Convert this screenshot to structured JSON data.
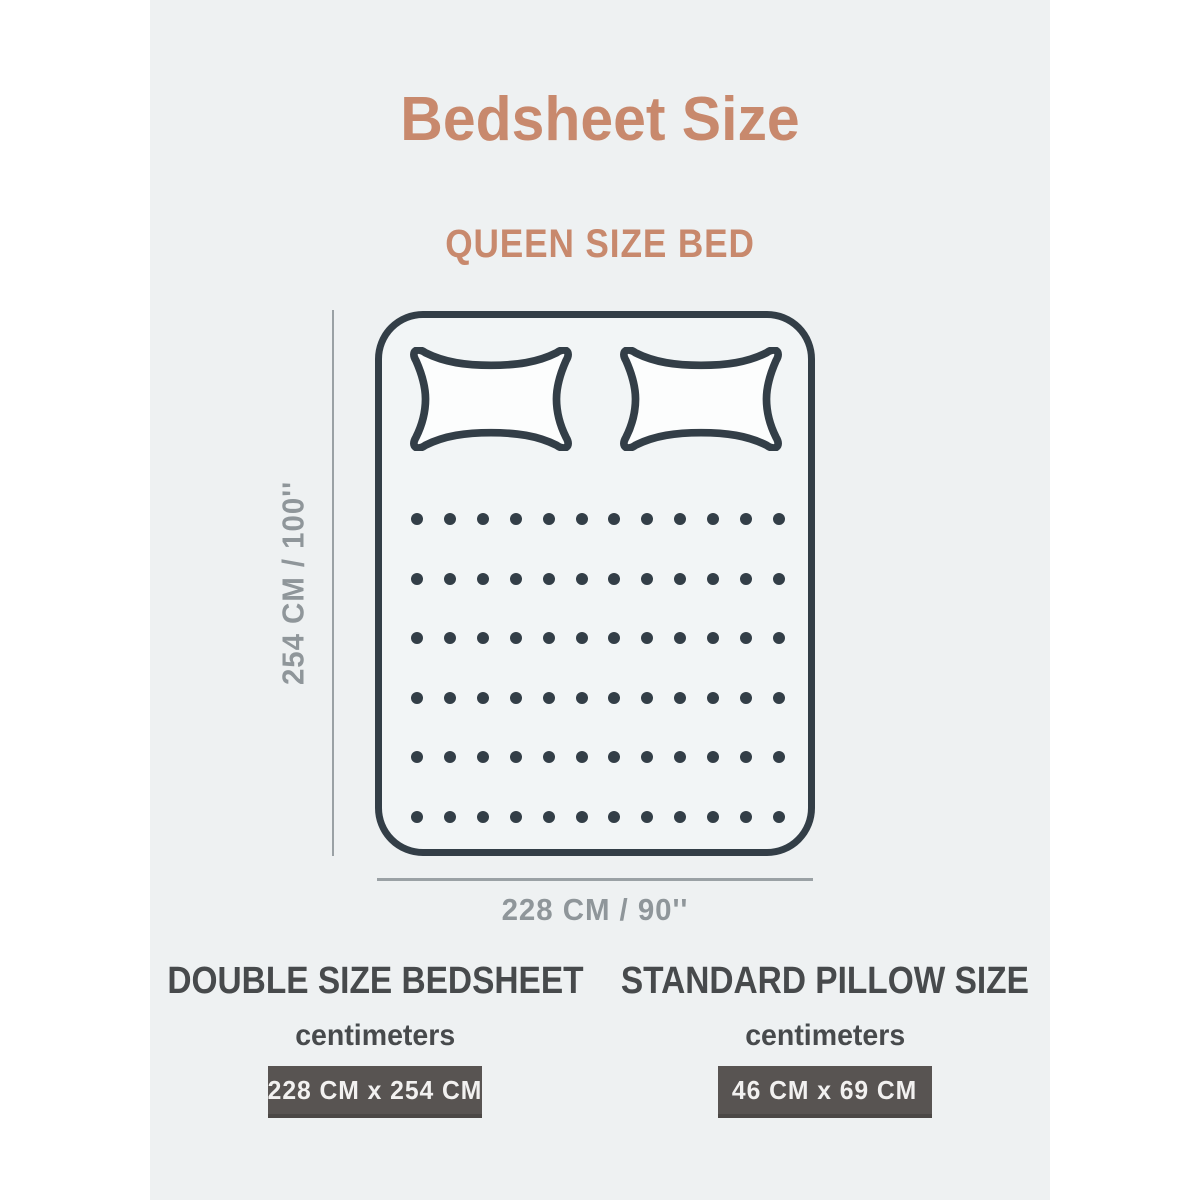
{
  "page": {
    "title": "Bedsheet Size",
    "subtitle": "QUEEN SIZE BED"
  },
  "diagram": {
    "height_label": "254 CM / 100''",
    "width_label": "228 CM / 90''",
    "pillow_count": 2,
    "dot_rows": 6,
    "dot_cols": 12
  },
  "specs": [
    {
      "title": "DOUBLE SIZE BEDSHEET",
      "unit_label": "centimeters",
      "value": "228 CM x 254 CM"
    },
    {
      "title": "STANDARD PILLOW SIZE",
      "unit_label": "centimeters",
      "value": "46 CM x 69 CM"
    }
  ],
  "colors": {
    "accent": "#c8896d",
    "ink": "#333e47",
    "dim_line": "#9aa1a5",
    "dim_text": "#8f969a",
    "heading": "#474a4c",
    "value_box_bg": "#585452",
    "value_box_text": "#f2f1f0",
    "panel_bg": "#eef1f2",
    "pillow_fill": "#fcfdfd"
  }
}
